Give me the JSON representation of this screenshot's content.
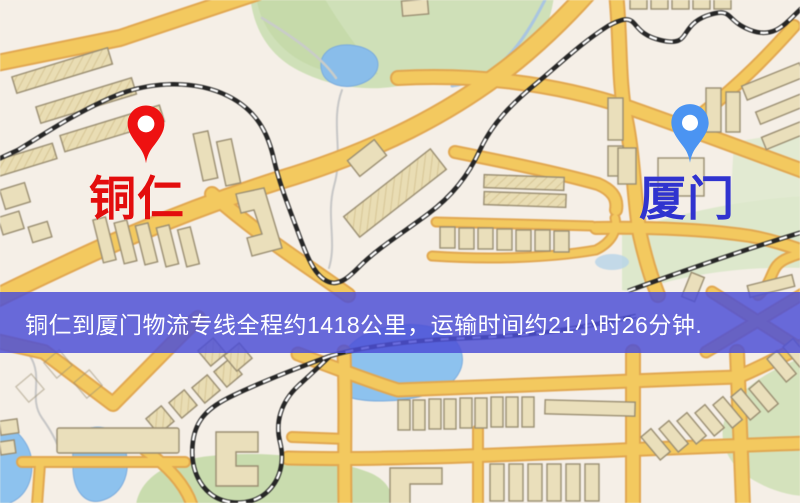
{
  "banner": {
    "text": "铜仁到厦门物流专线全程约1418公里，运输时间约21小时26分钟.",
    "background_color": "#4c4fd6",
    "text_color": "#ffffff"
  },
  "markers": {
    "origin": {
      "label": "铜仁",
      "pin_color": "#ee1111",
      "label_color": "#e30d0d"
    },
    "destination": {
      "label": "厦门",
      "pin_color": "#4b94f2",
      "label_color": "#3033cf"
    }
  },
  "route": {
    "origin": "铜仁",
    "destination": "厦门",
    "distance_text": "约1418公里",
    "duration_text": "约21小时26分钟"
  },
  "map": {
    "colors": {
      "background": "#f5efe7",
      "road_fill": "#f3c95f",
      "road_border": "#e1a750",
      "building_fill": "#eadfbb",
      "building_outline": "#9a8e72",
      "park_green": "#cfe0b8",
      "water_blue": "#8dc2ee",
      "railway_dark": "#262626"
    }
  }
}
